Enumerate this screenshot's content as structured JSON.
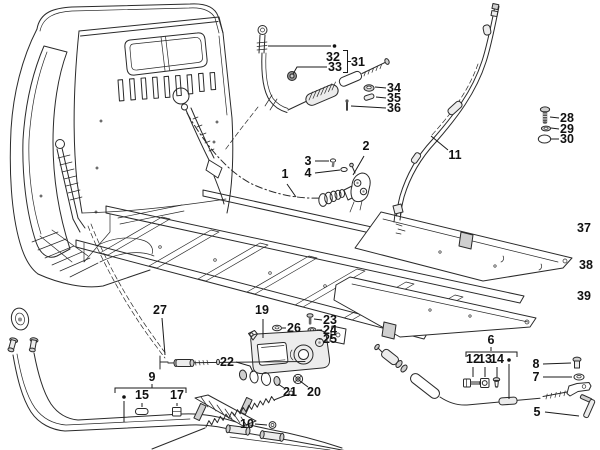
{
  "figure": {
    "kind": "exploded-parts-diagram",
    "background": "#ffffff",
    "ink": "#2a2a2a",
    "width": 600,
    "height": 450
  },
  "callouts": [
    {
      "label": "1",
      "x": 285,
      "y": 178,
      "leader": "287,184 296,197"
    },
    {
      "label": "2",
      "x": 366,
      "y": 150,
      "leader": "364,156 353,175"
    },
    {
      "label": "3",
      "x": 308,
      "y": 165,
      "leader": "315,161 329,161"
    },
    {
      "label": "4",
      "x": 308,
      "y": 177,
      "leader": "315,173 340,170"
    },
    {
      "label": "5",
      "x": 537,
      "y": 416,
      "leader": "545,412 579,416"
    },
    {
      "label": "6",
      "x": 491,
      "y": 344,
      "leader": "491,347 491,351"
    },
    {
      "label": "7",
      "x": 536,
      "y": 381,
      "leader": "543,377 572,377"
    },
    {
      "label": "8",
      "x": 536,
      "y": 368,
      "leader": "543,364 571,363"
    },
    {
      "label": "9",
      "x": 152,
      "y": 381,
      "leader": "152,384 152,388"
    },
    {
      "label": "10",
      "x": 247,
      "y": 428,
      "leader": "255,424 267,425"
    },
    {
      "label": "11",
      "x": 455,
      "y": 159,
      "leader": "448,150 431,136"
    },
    {
      "label": "12",
      "x": 473,
      "y": 363,
      "leader": "473,367 473,377"
    },
    {
      "label": "13",
      "x": 485,
      "y": 363,
      "leader": "485,367 485,377"
    },
    {
      "label": "14",
      "x": 497,
      "y": 363,
      "leader": "497,367 497,377"
    },
    {
      "label": "15",
      "x": 142,
      "y": 399,
      "leader": "142,403 142,407"
    },
    {
      "label": "17",
      "x": 177,
      "y": 399,
      "leader": "177,403 177,406"
    },
    {
      "label": "19",
      "x": 262,
      "y": 314,
      "leader": "263,319 263,338"
    },
    {
      "label": "20",
      "x": 314,
      "y": 396,
      "leader": "308,387 300,381"
    },
    {
      "label": "21",
      "x": 290,
      "y": 396,
      "leader": "284,388 278,384"
    },
    {
      "label": "22",
      "x": 227,
      "y": 366,
      "leader": "236,362 250,366 253,372"
    },
    {
      "label": "23",
      "x": 330,
      "y": 324,
      "leader": "322,320 314,319"
    },
    {
      "label": "24",
      "x": 330,
      "y": 334,
      "leader": "322,330 317,330"
    },
    {
      "label": "25",
      "x": 330,
      "y": 343,
      "leader": "322,339 319,339"
    },
    {
      "label": "26",
      "x": 294,
      "y": 332,
      "leader": "286,328 282,328"
    },
    {
      "label": "27",
      "x": 160,
      "y": 314,
      "leader": "162,318 165,355"
    },
    {
      "label": "28",
      "x": 567,
      "y": 122,
      "leader": "559,118 550,117"
    },
    {
      "label": "29",
      "x": 567,
      "y": 133,
      "leader": "559,129 551,128"
    },
    {
      "label": "30",
      "x": 567,
      "y": 143,
      "leader": "559,139 551,139"
    },
    {
      "label": "31",
      "x": 358,
      "y": 66
    },
    {
      "label": "32",
      "x": 333,
      "y": 61
    },
    {
      "label": "33",
      "x": 335,
      "y": 71,
      "leader": "327,67 297,67 293,74"
    },
    {
      "label": "34",
      "x": 394,
      "y": 92,
      "leader": "386,88 375,87"
    },
    {
      "label": "35",
      "x": 394,
      "y": 102,
      "leader": "386,98 376,97"
    },
    {
      "label": "36",
      "x": 394,
      "y": 112,
      "leader": "386,108 351,106"
    },
    {
      "label": "37",
      "x": 584,
      "y": 232
    },
    {
      "label": "38",
      "x": 586,
      "y": 269
    },
    {
      "label": "39",
      "x": 584,
      "y": 300
    }
  ]
}
